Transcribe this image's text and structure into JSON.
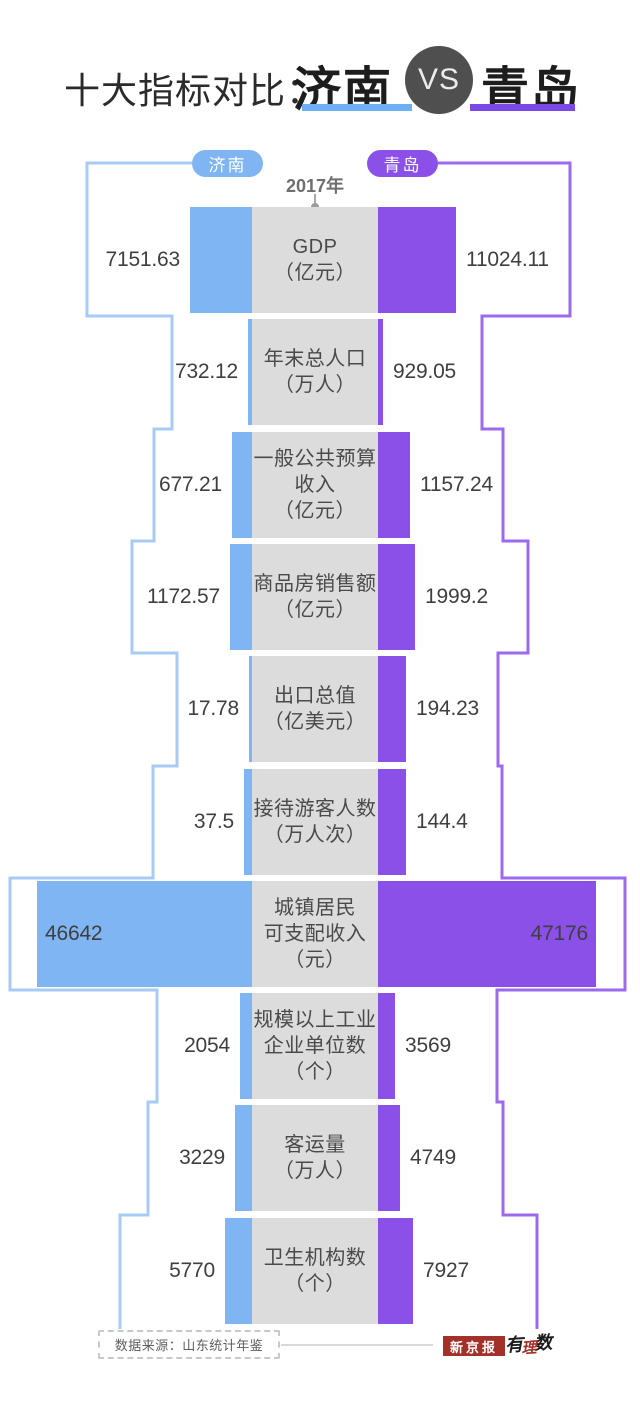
{
  "title": {
    "prefix": "十大指标对比：",
    "left_city": "济南",
    "vs_label": "VS",
    "right_city": "青岛"
  },
  "legend": {
    "left_label": "济南",
    "right_label": "青岛",
    "year_label": "2017年"
  },
  "colors": {
    "jinan_bar": "#7fb5f3",
    "jinan_outline": "#a7cbf5",
    "jinan_underline": "#6cb0f3",
    "qingdao_bar": "#8b50e8",
    "qingdao_outline": "#9c6aec",
    "qingdao_underline": "#7b49e8",
    "vs_circle": "#4f4f4f",
    "indicator_box": "#dcdcdc",
    "value_text": "#3f3f3f",
    "source_red": "#a4302a"
  },
  "footer": {
    "source": "数据来源：山东统计年鉴",
    "publisher": "新京报",
    "brand": [
      "有",
      "理",
      "数"
    ]
  },
  "chart_data": {
    "type": "bar",
    "title": "十大指标对比：济南 VS 青岛",
    "year": "2017年",
    "legend_position": "top",
    "series": [
      {
        "name": "济南",
        "color": "#7fb5f3"
      },
      {
        "name": "青岛",
        "color": "#8b50e8"
      }
    ],
    "rows": [
      {
        "indicator": "GDP",
        "unit": "亿元",
        "label_lines": [
          "GDP",
          "（亿元）"
        ],
        "jinan": 7151.63,
        "qingdao": 11024.11,
        "jinan_text": "7151.63",
        "qingdao_text": "11024.11",
        "layout": {
          "bar_px": [
            62,
            78
          ],
          "frame_px": [
            165,
            192
          ],
          "values_inside": false
        }
      },
      {
        "indicator": "年末总人口",
        "unit": "万人",
        "label_lines": [
          "年末总人口",
          "（万人）"
        ],
        "jinan": 732.12,
        "qingdao": 929.05,
        "jinan_text": "732.12",
        "qingdao_text": "929.05",
        "layout": {
          "bar_px": [
            4,
            5
          ],
          "frame_px": [
            80,
            104
          ],
          "values_inside": false
        }
      },
      {
        "indicator": "一般公共预算收入",
        "unit": "亿元",
        "label_lines": [
          "一般公共预算",
          "收入",
          "（亿元）"
        ],
        "jinan": 677.21,
        "qingdao": 1157.24,
        "jinan_text": "677.21",
        "qingdao_text": "1157.24",
        "layout": {
          "bar_px": [
            20,
            32
          ],
          "frame_px": [
            98,
            125
          ],
          "values_inside": false
        }
      },
      {
        "indicator": "商品房销售额",
        "unit": "亿元",
        "label_lines": [
          "商品房销售额",
          "（亿元）"
        ],
        "jinan": 1172.57,
        "qingdao": 1999.2,
        "jinan_text": "1172.57",
        "qingdao_text": "1999.2",
        "layout": {
          "bar_px": [
            22,
            37
          ],
          "frame_px": [
            120,
            150
          ],
          "values_inside": false
        }
      },
      {
        "indicator": "出口总值",
        "unit": "亿美元",
        "label_lines": [
          "出口总值",
          "（亿美元）"
        ],
        "jinan": 17.78,
        "qingdao": 194.23,
        "jinan_text": "17.78",
        "qingdao_text": "194.23",
        "layout": {
          "bar_px": [
            3,
            28
          ],
          "frame_px": [
            75,
            120
          ],
          "values_inside": false
        }
      },
      {
        "indicator": "接待游客人数",
        "unit": "万人次",
        "label_lines": [
          "接待游客人数",
          "（万人次）"
        ],
        "jinan": 37.5,
        "qingdao": 144.4,
        "jinan_text": "37.5",
        "qingdao_text": "144.4",
        "layout": {
          "bar_px": [
            8,
            28
          ],
          "frame_px": [
            99,
            124
          ],
          "values_inside": false
        }
      },
      {
        "indicator": "城镇居民可支配收入",
        "unit": "元",
        "label_lines": [
          "城镇居民",
          "可支配收入",
          "（元）"
        ],
        "jinan": 46642,
        "qingdao": 47176,
        "jinan_text": "46642",
        "qingdao_text": "47176",
        "layout": {
          "bar_px": [
            215,
            218
          ],
          "frame_px": [
            242,
            247
          ],
          "values_inside": true
        }
      },
      {
        "indicator": "规模以上工业企业单位数",
        "unit": "个",
        "label_lines": [
          "规模以上工业",
          "企业单位数",
          "（个）"
        ],
        "jinan": 2054,
        "qingdao": 3569,
        "jinan_text": "2054",
        "qingdao_text": "3569",
        "layout": {
          "bar_px": [
            12,
            17
          ],
          "frame_px": [
            95,
            119
          ],
          "values_inside": false
        }
      },
      {
        "indicator": "客运量",
        "unit": "万人",
        "label_lines": [
          "客运量",
          "（万人）"
        ],
        "jinan": 3229,
        "qingdao": 4749,
        "jinan_text": "3229",
        "qingdao_text": "4749",
        "layout": {
          "bar_px": [
            17,
            22
          ],
          "frame_px": [
            104,
            125
          ],
          "values_inside": false
        }
      },
      {
        "indicator": "卫生机构数",
        "unit": "个",
        "label_lines": [
          "卫生机构数",
          "（个）"
        ],
        "jinan": 5770,
        "qingdao": 7927,
        "jinan_text": "5770",
        "qingdao_text": "7927",
        "layout": {
          "bar_px": [
            27,
            35
          ],
          "frame_px": [
            132,
            159
          ],
          "values_inside": false
        }
      }
    ],
    "layout": {
      "first_row_top": 207,
      "row_pitch": 112.3,
      "row_height": 106,
      "box_left": 252,
      "box_width": 126,
      "legend_line_y": 163,
      "outline_end_y": 1329,
      "pill_left_edge": 192,
      "pill_right_edge": 438
    }
  }
}
